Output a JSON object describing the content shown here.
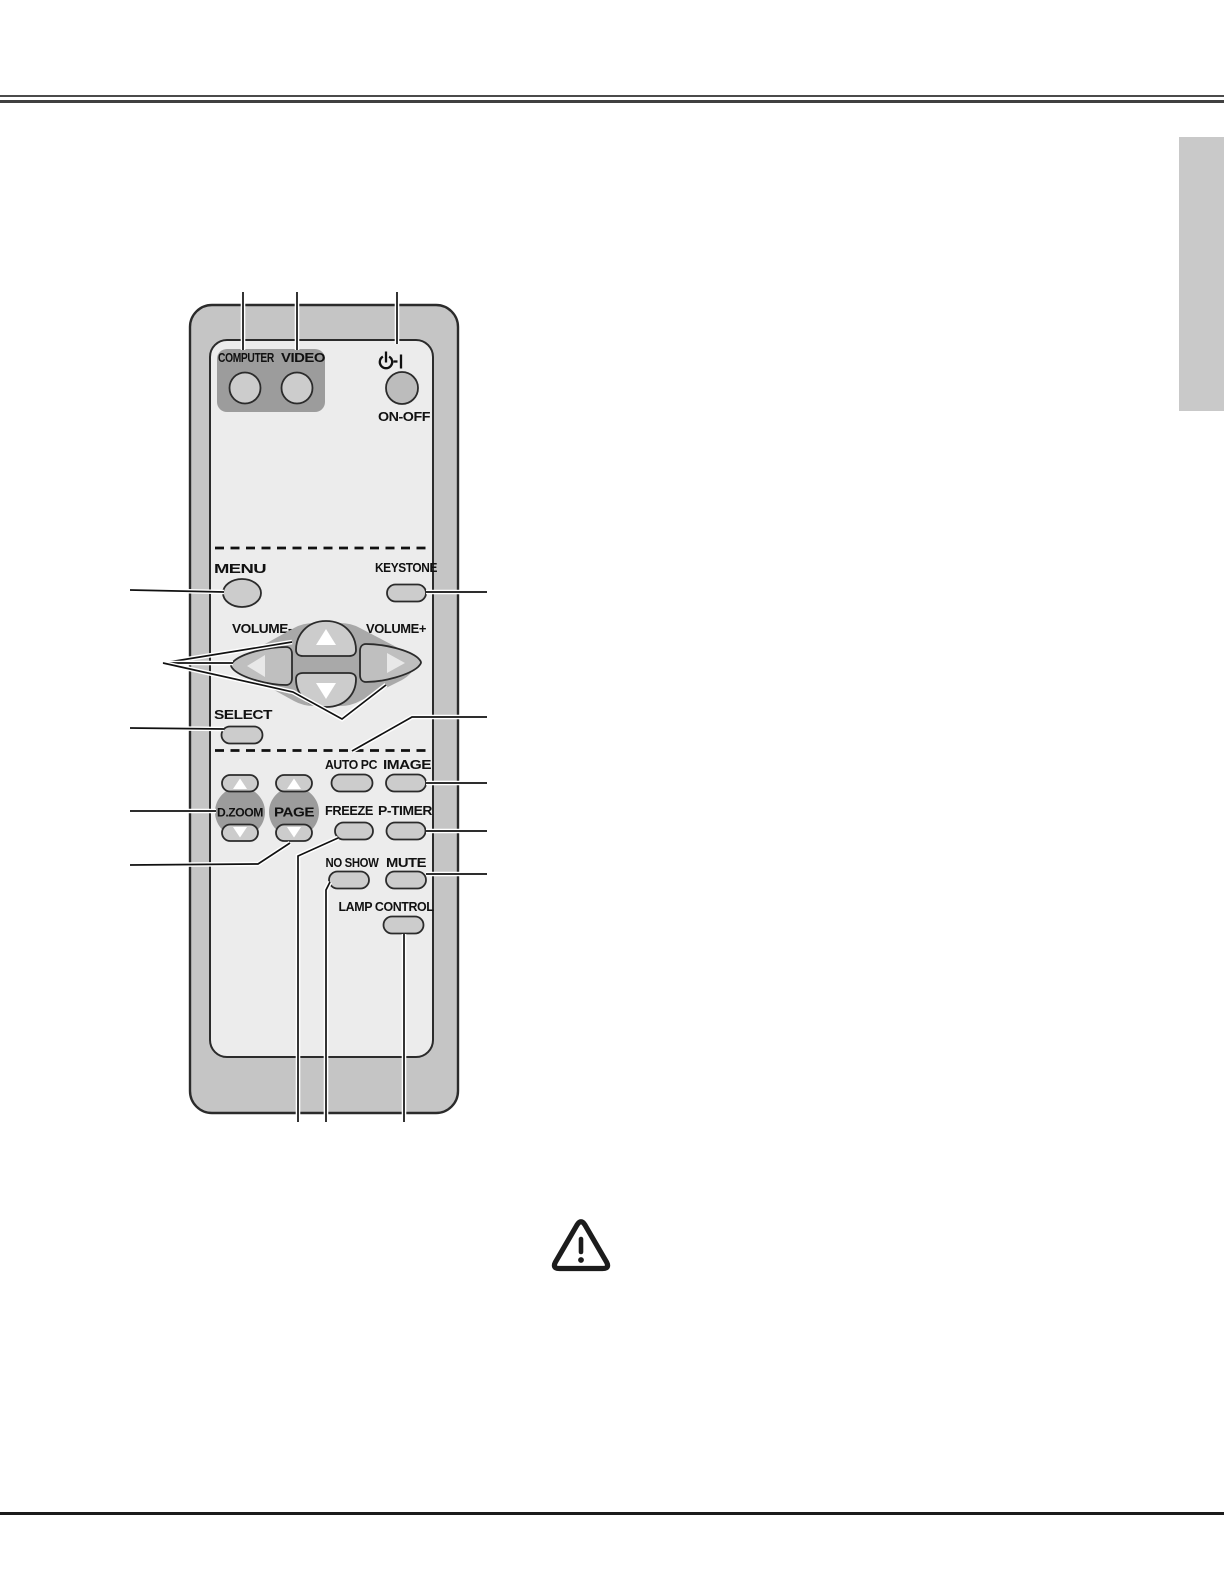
{
  "remote": {
    "source_group": {
      "computer_label": "COMPUTER",
      "video_label": "VIDEO"
    },
    "power": {
      "on_off_label": "ON-OFF"
    },
    "menu_label": "MENU",
    "keystone_label": "KEYSTONE",
    "volume_minus_label": "VOLUME-",
    "volume_plus_label": "VOLUME+",
    "select_label": "SELECT",
    "auto_pc_label": "AUTO PC",
    "image_label": "IMAGE",
    "d_zoom_label": "D.ZOOM",
    "page_label": "PAGE",
    "freeze_label": "FREEZE",
    "p_timer_label": "P-TIMER",
    "no_show_label": "NO SHOW",
    "mute_label": "MUTE",
    "lamp_control_label": "LAMP CONTROL"
  },
  "icons": {
    "power": "power-standby-icon",
    "warning": "warning-triangle-icon",
    "nav_up": "up-arrow-icon",
    "nav_down": "down-arrow-icon",
    "nav_left": "left-arrow-icon",
    "nav_right": "right-arrow-icon"
  },
  "colors": {
    "white": "#ffffff",
    "body": "#c5c5c5",
    "panel": "#ececec",
    "group_dark": "#9c9c9c",
    "button_light": "#cccccc",
    "button_mid": "#bfbfbf",
    "onoff_button": "#bcbcbc",
    "pad_bg": "#a9a9a9",
    "dial_dark": "#9c9c9c",
    "outline": "#2b2b2b",
    "text": "#111111",
    "side_tab": "#c9c9c9",
    "top_rule": "#404040",
    "bottom_rule": "#1b1b1b"
  }
}
